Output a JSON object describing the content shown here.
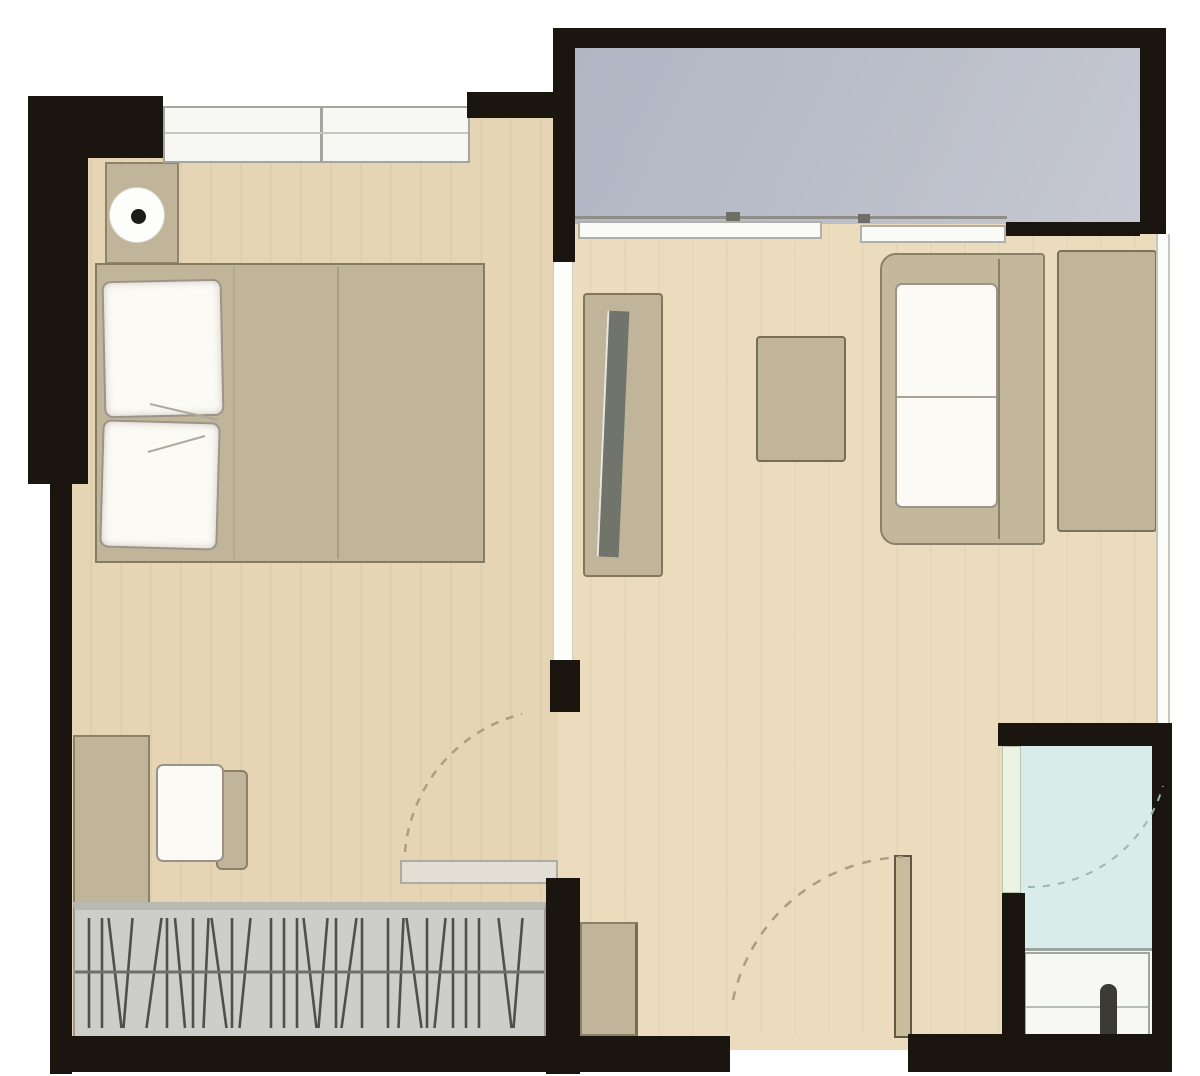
{
  "meta": {
    "title": "Studio apartment floor plan",
    "view": "top-down architectural plan",
    "visible_text": "none"
  },
  "colors": {
    "exterior": "#ffffff",
    "wall": "#1a150f",
    "bedroom_floor": "#e6d5b5",
    "living_floor": "#ebdcbd",
    "balcony_floor": "#b9bdc9",
    "bathroom_floor": "#d8edea",
    "vanity_white": "#f7f7f3",
    "furniture_tan": "#c0b59a",
    "bed_tan": "#c0b598",
    "sofa_tan": "#c3b89b",
    "cushion_white": "#fbfaf5",
    "window_white": "#f7f7f3",
    "window_border": "#a5a59d",
    "wardrobe_gray": "#cdcdca",
    "wardrobe_stroke": "#50504a",
    "door_arc": "#ab9d7e",
    "lamp_dot": "#1c1c1c",
    "tv_dark": "#70746a",
    "faucet_dark": "#3b3b33",
    "bath_door_leaf": "#ecf3e2"
  },
  "rooms": [
    {
      "name": "bedroom",
      "position": "top-left",
      "floor_color_key": "bedroom_floor"
    },
    {
      "name": "living-area",
      "position": "center-right",
      "floor_color_key": "living_floor"
    },
    {
      "name": "balcony",
      "position": "top-right",
      "floor_color_key": "balcony_floor"
    },
    {
      "name": "hallway-entry",
      "position": "bottom-center",
      "floor_color_key": "living_floor"
    },
    {
      "name": "bathroom",
      "position": "bottom-right",
      "floor_color_key": "bathroom_floor"
    }
  ],
  "furniture": [
    {
      "name": "double-bed",
      "room": "bedroom",
      "details": "two white pillows, blanket fold line"
    },
    {
      "name": "nightstand-with-lamp",
      "room": "bedroom"
    },
    {
      "name": "desk",
      "room": "bedroom"
    },
    {
      "name": "desk-chair",
      "room": "bedroom"
    },
    {
      "name": "wardrobe-hanging-rail",
      "room": "bedroom",
      "details": "hatched clothes symbol"
    },
    {
      "name": "tv-cabinet-with-tv",
      "room": "living-area"
    },
    {
      "name": "coffee-table",
      "room": "living-area"
    },
    {
      "name": "sofa-with-cushions",
      "room": "living-area"
    },
    {
      "name": "side-table",
      "room": "living-area"
    },
    {
      "name": "shoe-cabinet",
      "room": "hallway-entry"
    },
    {
      "name": "vanity-sink-with-faucet",
      "room": "bathroom"
    }
  ],
  "openings": [
    {
      "name": "bedroom-top-window",
      "wall": "north"
    },
    {
      "name": "balcony-sliding-window",
      "wall": "between balcony and living area"
    },
    {
      "name": "right-side-window-strip",
      "wall": "east"
    },
    {
      "name": "bedroom-door",
      "type": "swing with dashed arc"
    },
    {
      "name": "entry-door",
      "type": "swing with dashed arc",
      "wall": "south"
    },
    {
      "name": "bathroom-door",
      "type": "swing with dashed arc"
    }
  ]
}
